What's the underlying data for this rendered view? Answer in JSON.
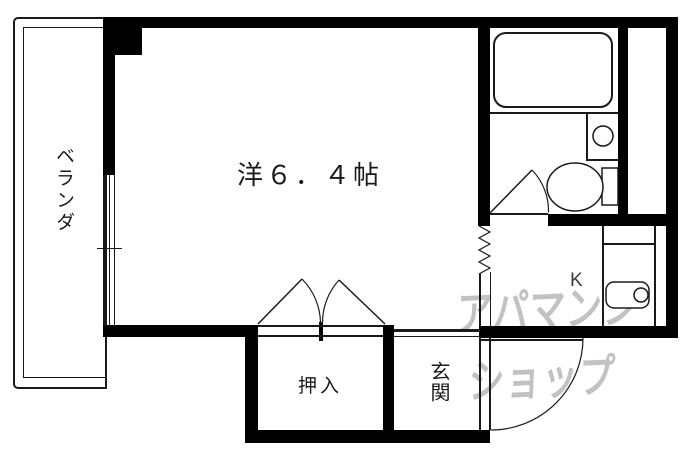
{
  "floorplan": {
    "type": "japanese-apartment-floorplan",
    "rooms": {
      "veranda": {
        "label": "ベランダ"
      },
      "main_room": {
        "label": "洋６．４帖"
      },
      "closet": {
        "label": "押入"
      },
      "entrance": {
        "label": "玄関"
      },
      "kitchen": {
        "label": "K"
      }
    },
    "fixtures": {
      "bathtub": "bathtub",
      "toilet": "toilet",
      "bathroom_sink": "round-basin",
      "kitchen_sink": "sink-with-faucet",
      "window": "triple-line-window",
      "accordion_door": "zigzag-folding-door",
      "closet_doors": "double-fold-doors",
      "bathroom_door": "swing-door",
      "entrance_door": "swing-door-arc"
    },
    "watermark": {
      "line1": "アパマンシ",
      "line2": "ショップ",
      "color": "#c2c2c2"
    },
    "colors": {
      "wall": "#000000",
      "line": "#1a1a1a",
      "background": "#ffffff"
    }
  }
}
